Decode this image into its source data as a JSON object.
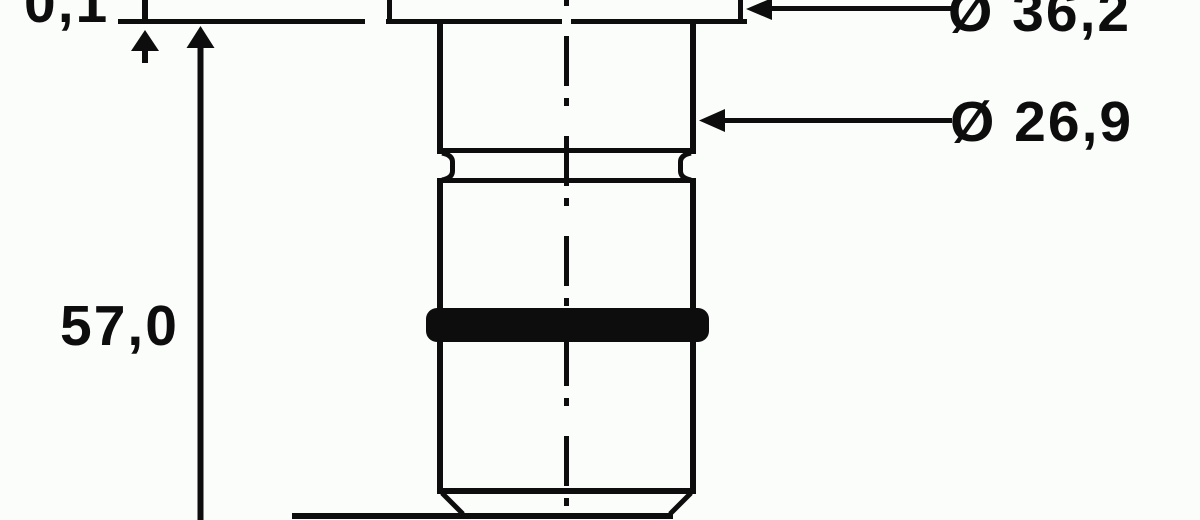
{
  "drawing": {
    "labels": {
      "step": "0,1",
      "height": "57,0",
      "flange_diameter": "Ø 36,2",
      "body_diameter": "Ø 26,9"
    },
    "colors": {
      "ink": "#0d0d0d",
      "background": "#fbfdfb"
    }
  }
}
